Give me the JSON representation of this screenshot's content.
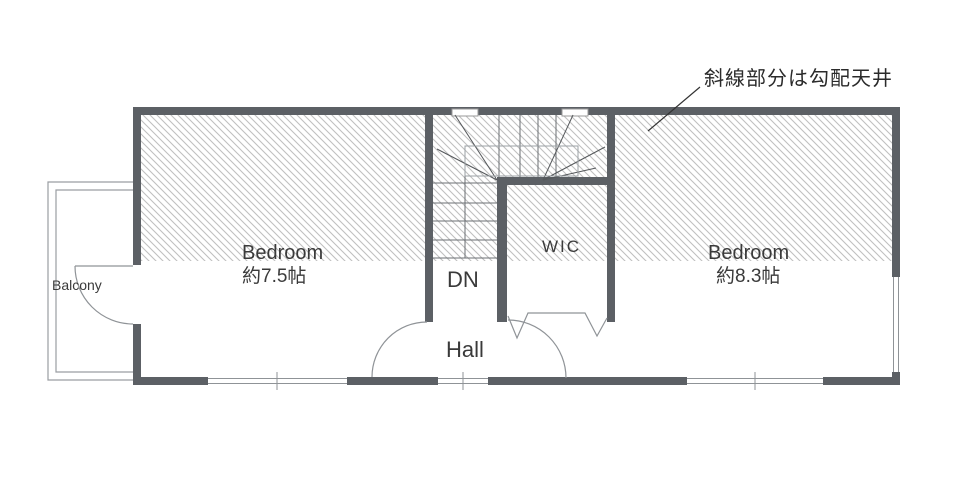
{
  "title": "2F floor plan",
  "annotation": {
    "text": "斜線部分は勾配天井"
  },
  "rooms": {
    "bedroom_left": {
      "name": "Bedroom",
      "size": "約7.5帖"
    },
    "bedroom_right": {
      "name": "Bedroom",
      "size": "約8.3帖"
    },
    "wic": {
      "name": "WIC"
    },
    "hall": {
      "name": "Hall"
    },
    "stairs": {
      "label": "DN"
    },
    "balcony": {
      "name": "Balcony"
    }
  },
  "colors": {
    "wall": "#5c6065",
    "hatch_line": "#c0c0c0",
    "thin_line": "#8f9397",
    "stair_line": "#6b6f73",
    "text": "#3a3a3a"
  }
}
